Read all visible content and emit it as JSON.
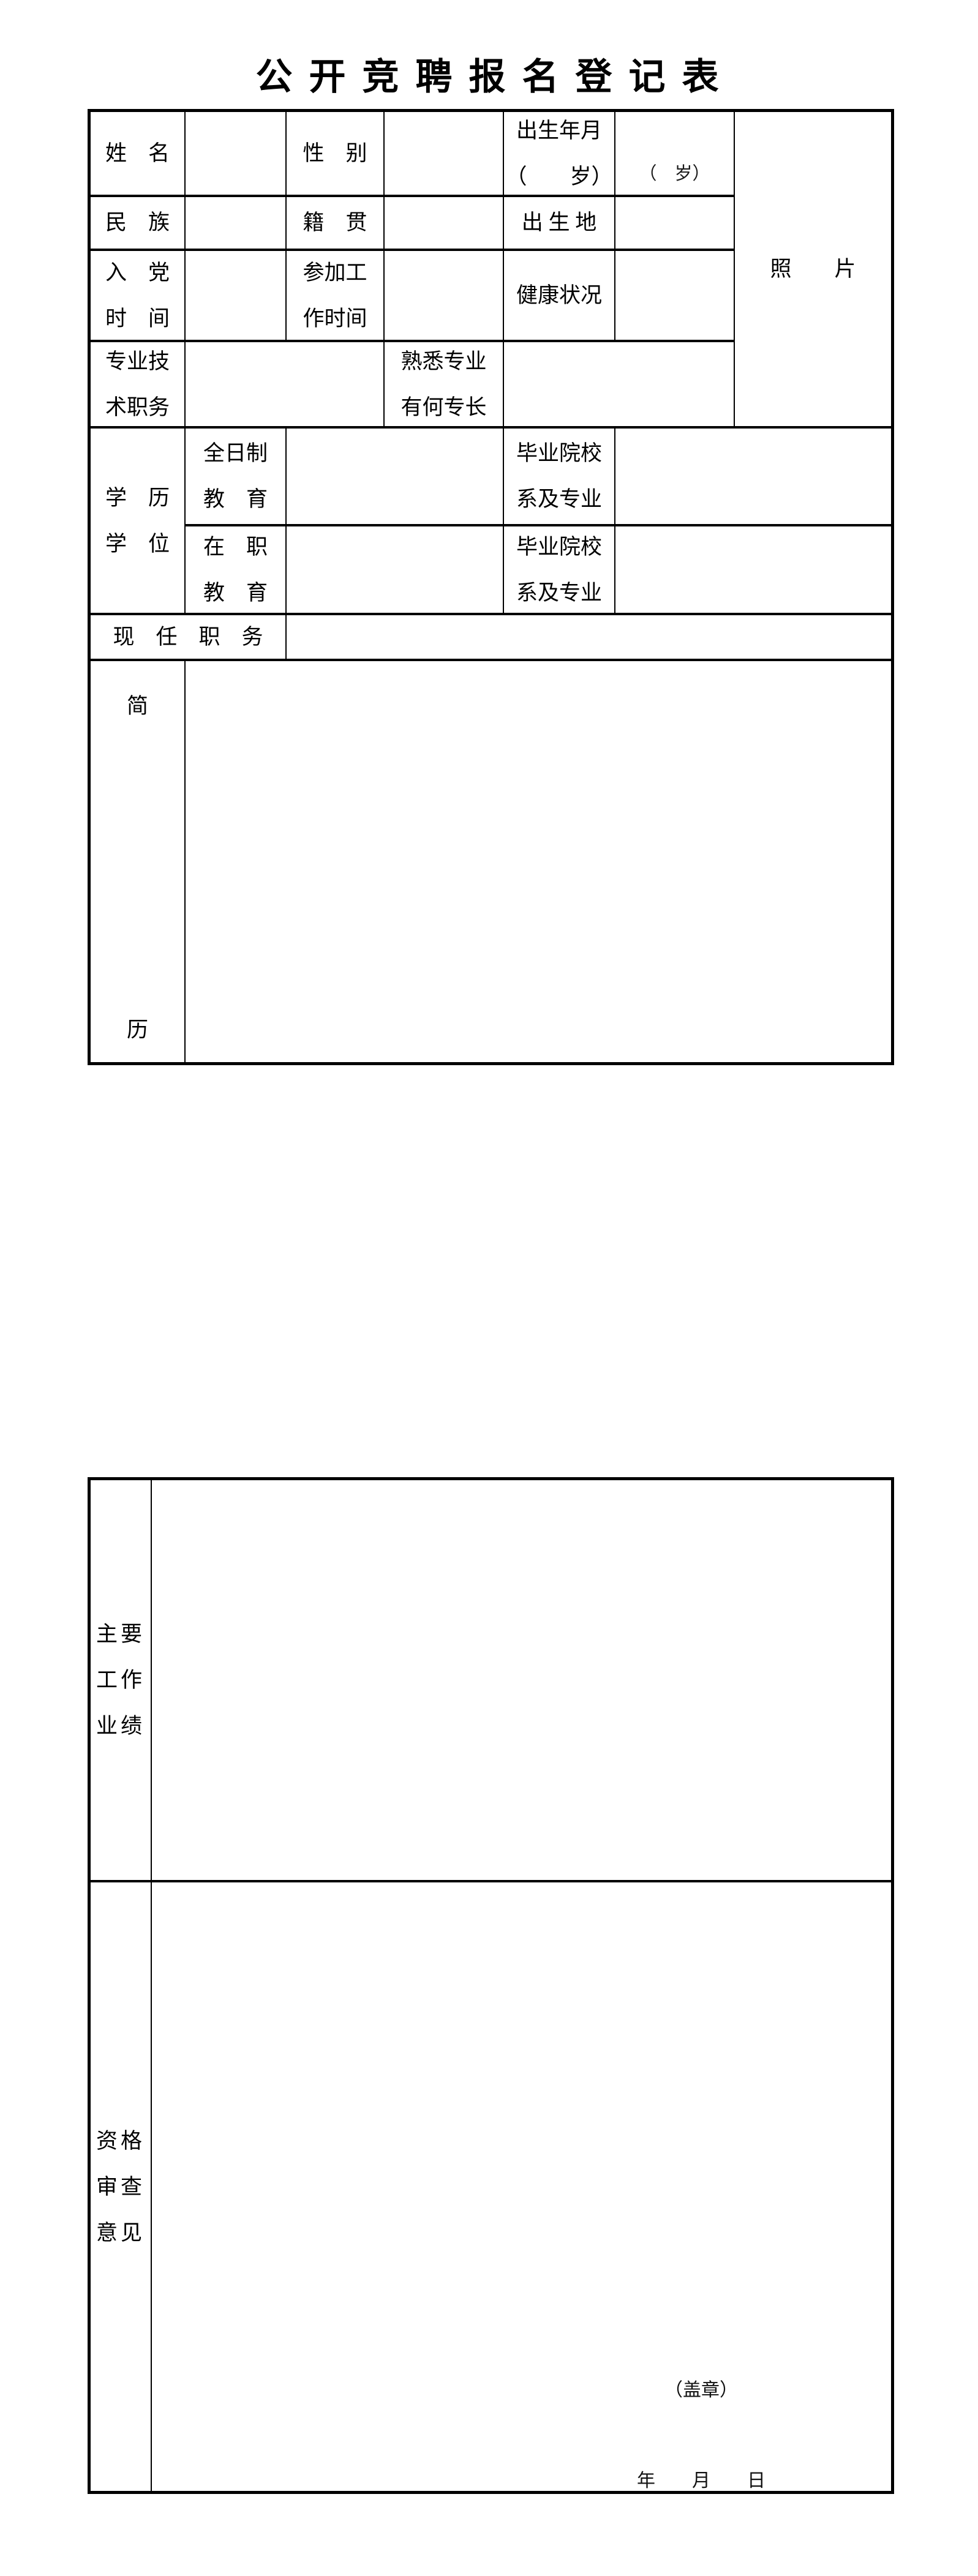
{
  "colors": {
    "paper": "#ffffff",
    "ink": "#000000"
  },
  "title": "公 开 竞 聘 报 名 登 记 表",
  "t1": {
    "name": "姓　名",
    "gender": "性　别",
    "birth1": "出生年月",
    "birth2": "（　　岁）",
    "birth_hint": "（　岁）",
    "photo": "照　　片",
    "ethnic": "民　族",
    "native": "籍　贯",
    "birthplace": "出 生 地",
    "party1": "入　党",
    "party2": "时　间",
    "workstart1": "参加工",
    "workstart2": "作时间",
    "health": "健康状况",
    "protitle1": "专业技",
    "protitle2": "术职务",
    "specialty1": "熟悉专业",
    "specialty2": "有何专长",
    "edu1": "学　历",
    "edu2": "学　位",
    "fulltime1": "全日制",
    "fulltime2": "教　育",
    "school_a1": "毕业院校",
    "school_a2": "系及专业",
    "onjob1": "在　职",
    "onjob2": "教　育",
    "school_b1": "毕业院校",
    "school_b2": "系及专业",
    "post": "现　任　职　务",
    "resume_top": "简",
    "resume_bottom": "历"
  },
  "t2": {
    "ach1": "主要",
    "ach2": "工作",
    "ach3": "业绩",
    "rev1": "资格",
    "rev2": "审查",
    "rev3": "意见",
    "seal": "（盖章）",
    "date": "年　　月　　日"
  }
}
